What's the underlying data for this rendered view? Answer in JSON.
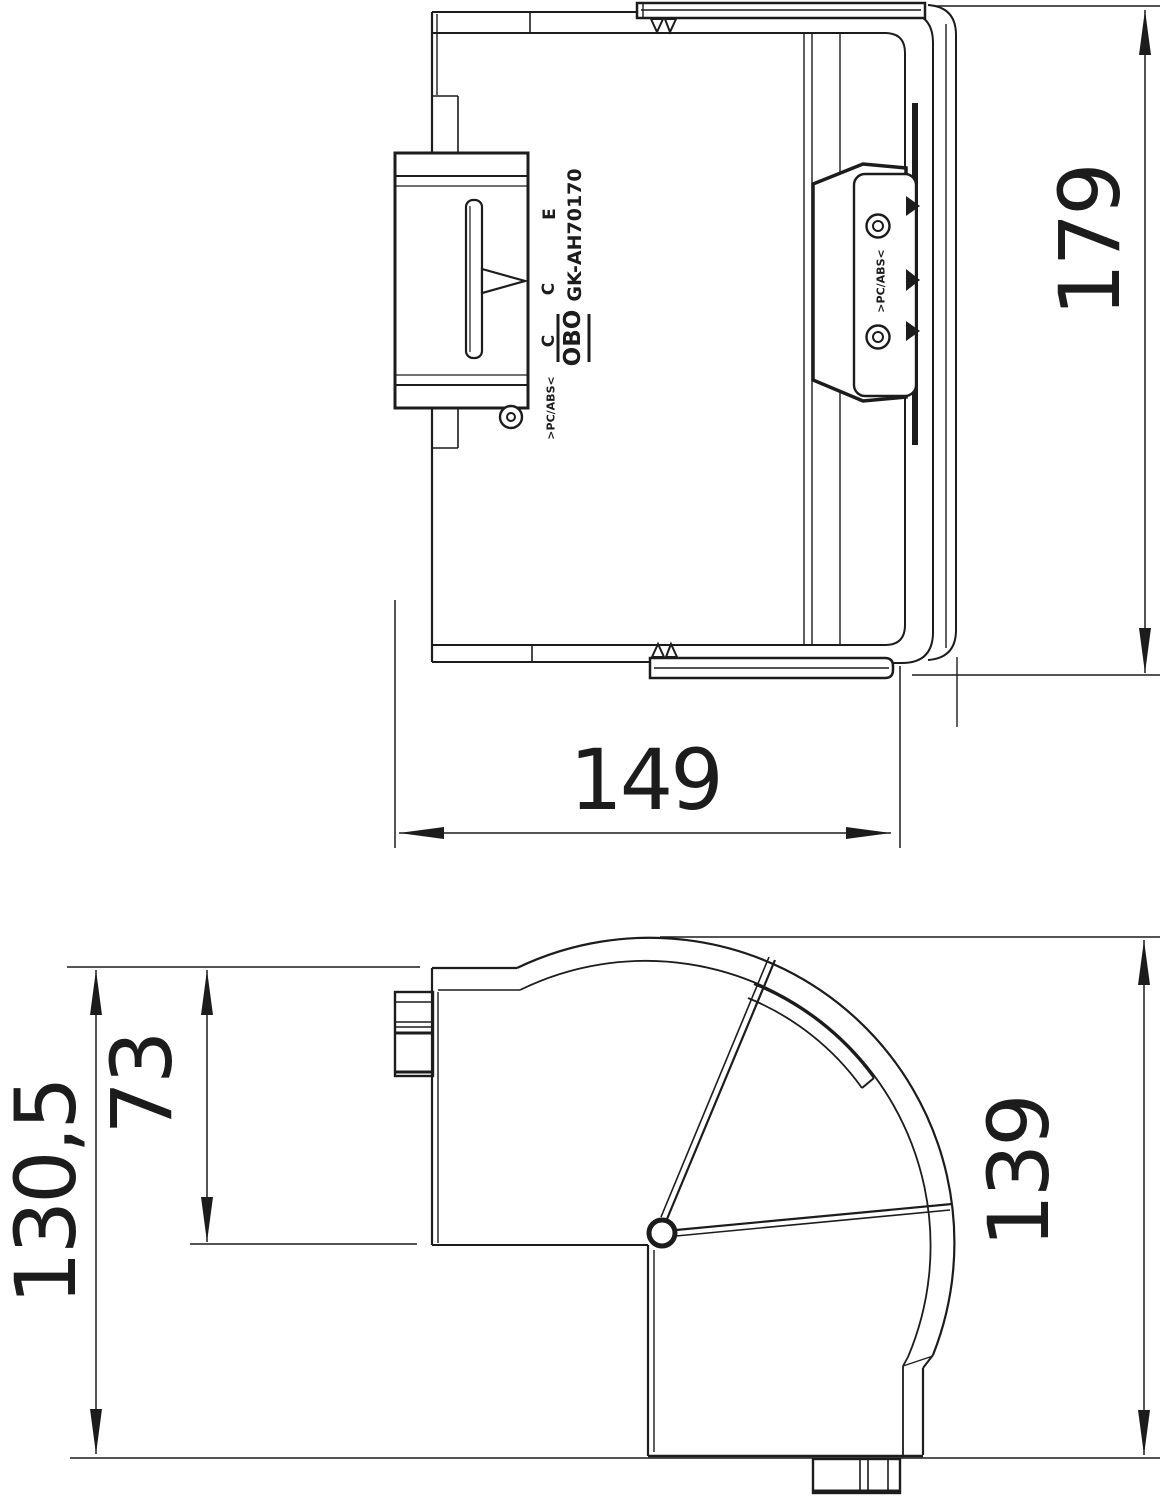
{
  "drawing": {
    "background_color": "#ffffff",
    "line_color": "#1c1c1c",
    "part": {
      "product_code": "GK-AH70170",
      "brand_logo": "OBO",
      "material_marking_left": ">PC/ABS<",
      "material_marking_right": ">PC/ABS<",
      "mold_mark_top": "E",
      "mold_mark_middle": "C",
      "mold_mark_bottom": "C"
    },
    "dimensions": {
      "top_view_height": "179",
      "top_view_width": "149",
      "side_view_total_height": "130,5",
      "side_view_duct_height": "73",
      "side_view_leg_length": "139"
    }
  }
}
